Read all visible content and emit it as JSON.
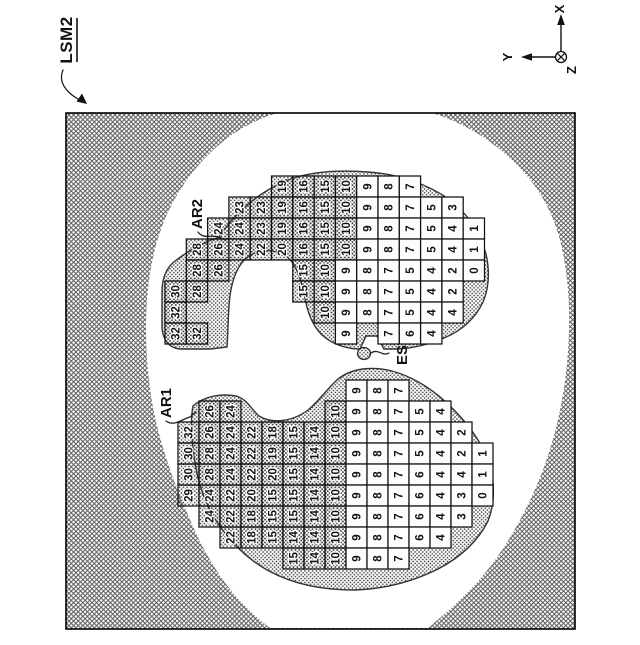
{
  "figure_label": {
    "text": "LSM2"
  },
  "axis": {
    "x": "X",
    "y": "Y",
    "z": "Z"
  },
  "labels": {
    "ar1": "AR1",
    "ar2": "AR2",
    "es": "ES"
  },
  "colors": {
    "ink": "#111111",
    "hatch": "#5a5a5a",
    "stipple_dot": "#3f3f3f",
    "cell_white": "#fdfdfd",
    "background": "#ffffff"
  },
  "grids": {
    "AR2": {
      "x0": 165,
      "y0": 176,
      "cw": 21.3,
      "ch": 21,
      "shade_min": 10,
      "rows": [
        {
          "r": 0,
          "cells": [
            [
              5,
              19
            ],
            [
              6,
              16
            ],
            [
              7,
              15
            ],
            [
              8,
              10
            ],
            [
              9,
              9
            ],
            [
              10,
              8
            ],
            [
              11,
              7
            ]
          ]
        },
        {
          "r": 1,
          "cells": [
            [
              3,
              23
            ],
            [
              4,
              23
            ],
            [
              5,
              19
            ],
            [
              6,
              16
            ],
            [
              7,
              15
            ],
            [
              8,
              10
            ],
            [
              9,
              9
            ],
            [
              10,
              8
            ],
            [
              11,
              7
            ],
            [
              12,
              5
            ],
            [
              13,
              3
            ]
          ]
        },
        {
          "r": 2,
          "cells": [
            [
              2,
              24
            ],
            [
              3,
              24
            ],
            [
              4,
              23
            ],
            [
              5,
              19
            ],
            [
              6,
              16
            ],
            [
              7,
              15
            ],
            [
              8,
              10
            ],
            [
              9,
              9
            ],
            [
              10,
              8
            ],
            [
              11,
              7
            ],
            [
              12,
              5
            ],
            [
              13,
              4
            ],
            [
              14,
              1
            ]
          ]
        },
        {
          "r": 3,
          "cells": [
            [
              1,
              28
            ],
            [
              2,
              26
            ],
            [
              3,
              24
            ],
            [
              4,
              22
            ],
            [
              5,
              20
            ],
            [
              6,
              16
            ],
            [
              7,
              15
            ],
            [
              8,
              10
            ],
            [
              9,
              9
            ],
            [
              10,
              8
            ],
            [
              11,
              7
            ],
            [
              12,
              5
            ],
            [
              13,
              4
            ],
            [
              14,
              1
            ]
          ]
        },
        {
          "r": 4,
          "cells": [
            [
              1,
              28
            ],
            [
              2,
              26
            ],
            [
              6,
              15
            ],
            [
              7,
              10
            ],
            [
              8,
              9
            ],
            [
              9,
              8
            ],
            [
              10,
              7
            ],
            [
              11,
              5
            ],
            [
              12,
              4
            ],
            [
              13,
              2
            ],
            [
              14,
              0
            ]
          ]
        },
        {
          "r": 5,
          "cells": [
            [
              0,
              30
            ],
            [
              1,
              28
            ],
            [
              6,
              15
            ],
            [
              7,
              10
            ],
            [
              8,
              9
            ],
            [
              9,
              8
            ],
            [
              10,
              7
            ],
            [
              11,
              5
            ],
            [
              12,
              4
            ],
            [
              13,
              2
            ]
          ]
        },
        {
          "r": 6,
          "cells": [
            [
              0,
              32
            ],
            [
              7,
              10
            ],
            [
              8,
              9
            ],
            [
              9,
              8
            ],
            [
              10,
              7
            ],
            [
              11,
              5
            ],
            [
              12,
              4
            ],
            [
              13,
              4
            ]
          ]
        },
        {
          "r": 7,
          "cells": [
            [
              0,
              32
            ],
            [
              1,
              32
            ],
            [
              8,
              9
            ],
            [
              10,
              7
            ],
            [
              11,
              6
            ],
            [
              12,
              4
            ]
          ]
        }
      ]
    },
    "AR1": {
      "x0": 178,
      "y0": 380,
      "cw": 21,
      "ch": 21,
      "shade_min": 10,
      "rows": [
        {
          "r": 0,
          "cells": [
            [
              8,
              9
            ],
            [
              9,
              8
            ],
            [
              10,
              7
            ]
          ]
        },
        {
          "r": 1,
          "cells": [
            [
              1,
              26
            ],
            [
              2,
              24
            ],
            [
              7,
              10
            ],
            [
              8,
              9
            ],
            [
              9,
              8
            ],
            [
              10,
              7
            ],
            [
              11,
              5
            ],
            [
              12,
              4
            ]
          ]
        },
        {
          "r": 2,
          "cells": [
            [
              0,
              32
            ],
            [
              1,
              26
            ],
            [
              2,
              24
            ],
            [
              3,
              22
            ],
            [
              4,
              18
            ],
            [
              5,
              15
            ],
            [
              6,
              14
            ],
            [
              7,
              10
            ],
            [
              8,
              9
            ],
            [
              9,
              8
            ],
            [
              10,
              7
            ],
            [
              11,
              5
            ],
            [
              12,
              4
            ],
            [
              13,
              2
            ]
          ]
        },
        {
          "r": 3,
          "cells": [
            [
              0,
              30
            ],
            [
              1,
              28
            ],
            [
              2,
              24
            ],
            [
              3,
              22
            ],
            [
              4,
              19
            ],
            [
              5,
              15
            ],
            [
              6,
              14
            ],
            [
              7,
              10
            ],
            [
              8,
              9
            ],
            [
              9,
              8
            ],
            [
              10,
              7
            ],
            [
              11,
              5
            ],
            [
              12,
              4
            ],
            [
              13,
              2
            ],
            [
              14,
              1
            ]
          ]
        },
        {
          "r": 4,
          "cells": [
            [
              0,
              30
            ],
            [
              1,
              28
            ],
            [
              2,
              24
            ],
            [
              3,
              22
            ],
            [
              4,
              20
            ],
            [
              5,
              15
            ],
            [
              6,
              14
            ],
            [
              7,
              10
            ],
            [
              8,
              9
            ],
            [
              9,
              8
            ],
            [
              10,
              7
            ],
            [
              11,
              6
            ],
            [
              12,
              4
            ],
            [
              13,
              4
            ],
            [
              14,
              1
            ]
          ]
        },
        {
          "r": 5,
          "cells": [
            [
              0,
              29
            ],
            [
              1,
              24
            ],
            [
              2,
              22
            ],
            [
              3,
              20
            ],
            [
              4,
              15
            ],
            [
              5,
              15
            ],
            [
              6,
              14
            ],
            [
              7,
              10
            ],
            [
              8,
              9
            ],
            [
              9,
              8
            ],
            [
              10,
              7
            ],
            [
              11,
              6
            ],
            [
              12,
              4
            ],
            [
              13,
              3
            ],
            [
              14,
              0
            ]
          ]
        },
        {
          "r": 6,
          "cells": [
            [
              1,
              24
            ],
            [
              2,
              22
            ],
            [
              3,
              18
            ],
            [
              4,
              15
            ],
            [
              5,
              15
            ],
            [
              6,
              14
            ],
            [
              7,
              10
            ],
            [
              8,
              9
            ],
            [
              9,
              8
            ],
            [
              10,
              7
            ],
            [
              11,
              6
            ],
            [
              12,
              4
            ],
            [
              13,
              3
            ]
          ]
        },
        {
          "r": 7,
          "cells": [
            [
              2,
              22
            ],
            [
              3,
              18
            ],
            [
              4,
              15
            ],
            [
              5,
              14
            ],
            [
              6,
              14
            ],
            [
              7,
              10
            ],
            [
              8,
              9
            ],
            [
              9,
              8
            ],
            [
              10,
              7
            ],
            [
              11,
              6
            ],
            [
              12,
              4
            ]
          ]
        },
        {
          "r": 8,
          "cells": [
            [
              5,
              15
            ],
            [
              6,
              14
            ],
            [
              7,
              10
            ],
            [
              8,
              9
            ],
            [
              9,
              8
            ],
            [
              10,
              7
            ]
          ]
        }
      ]
    }
  }
}
